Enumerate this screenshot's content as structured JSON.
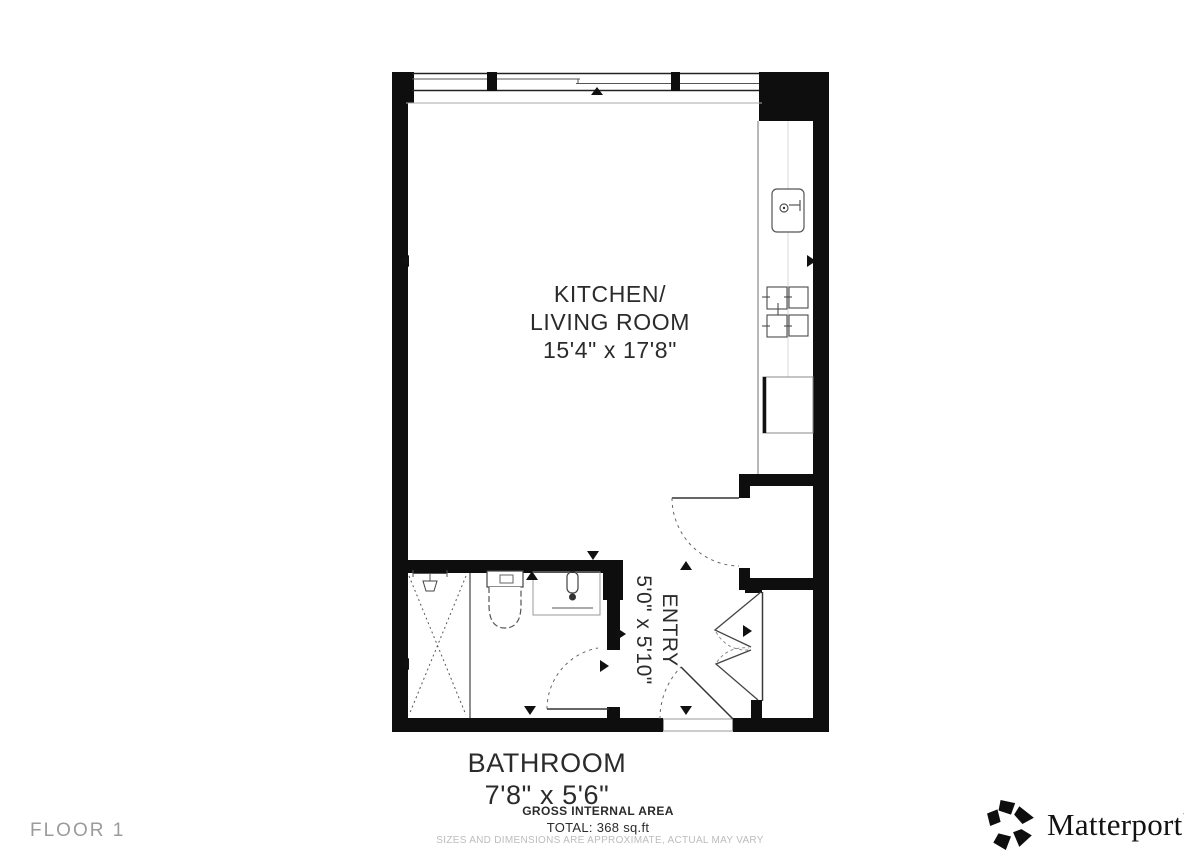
{
  "colors": {
    "wall": "#0e0e0e",
    "plan_line": "#555555",
    "text": "#2b2b2b",
    "muted_text": "#9b9b9b",
    "disclaimer_text": "#bcbcbc",
    "background": "#ffffff"
  },
  "floor_plan": {
    "rooms": {
      "kitchen_living": {
        "name_line1": "KITCHEN/",
        "name_line2": "LIVING ROOM",
        "dimensions": "15'4\" x 17'8\""
      },
      "entry": {
        "name": "ENTRY",
        "dimensions": "5'0\" x 5'10\""
      },
      "bathroom": {
        "name": "BATHROOM",
        "dimensions": "7'8\" x 5'6\""
      }
    },
    "area_summary": {
      "title": "GROSS INTERNAL AREA",
      "total": "TOTAL: 368 sq.ft"
    },
    "disclaimer": "SIZES AND DIMENSIONS ARE APPROXIMATE, ACTUAL MAY VARY",
    "floor_label": "FLOOR 1"
  },
  "branding": {
    "logo_text": "Matterport",
    "trademark": "™"
  }
}
